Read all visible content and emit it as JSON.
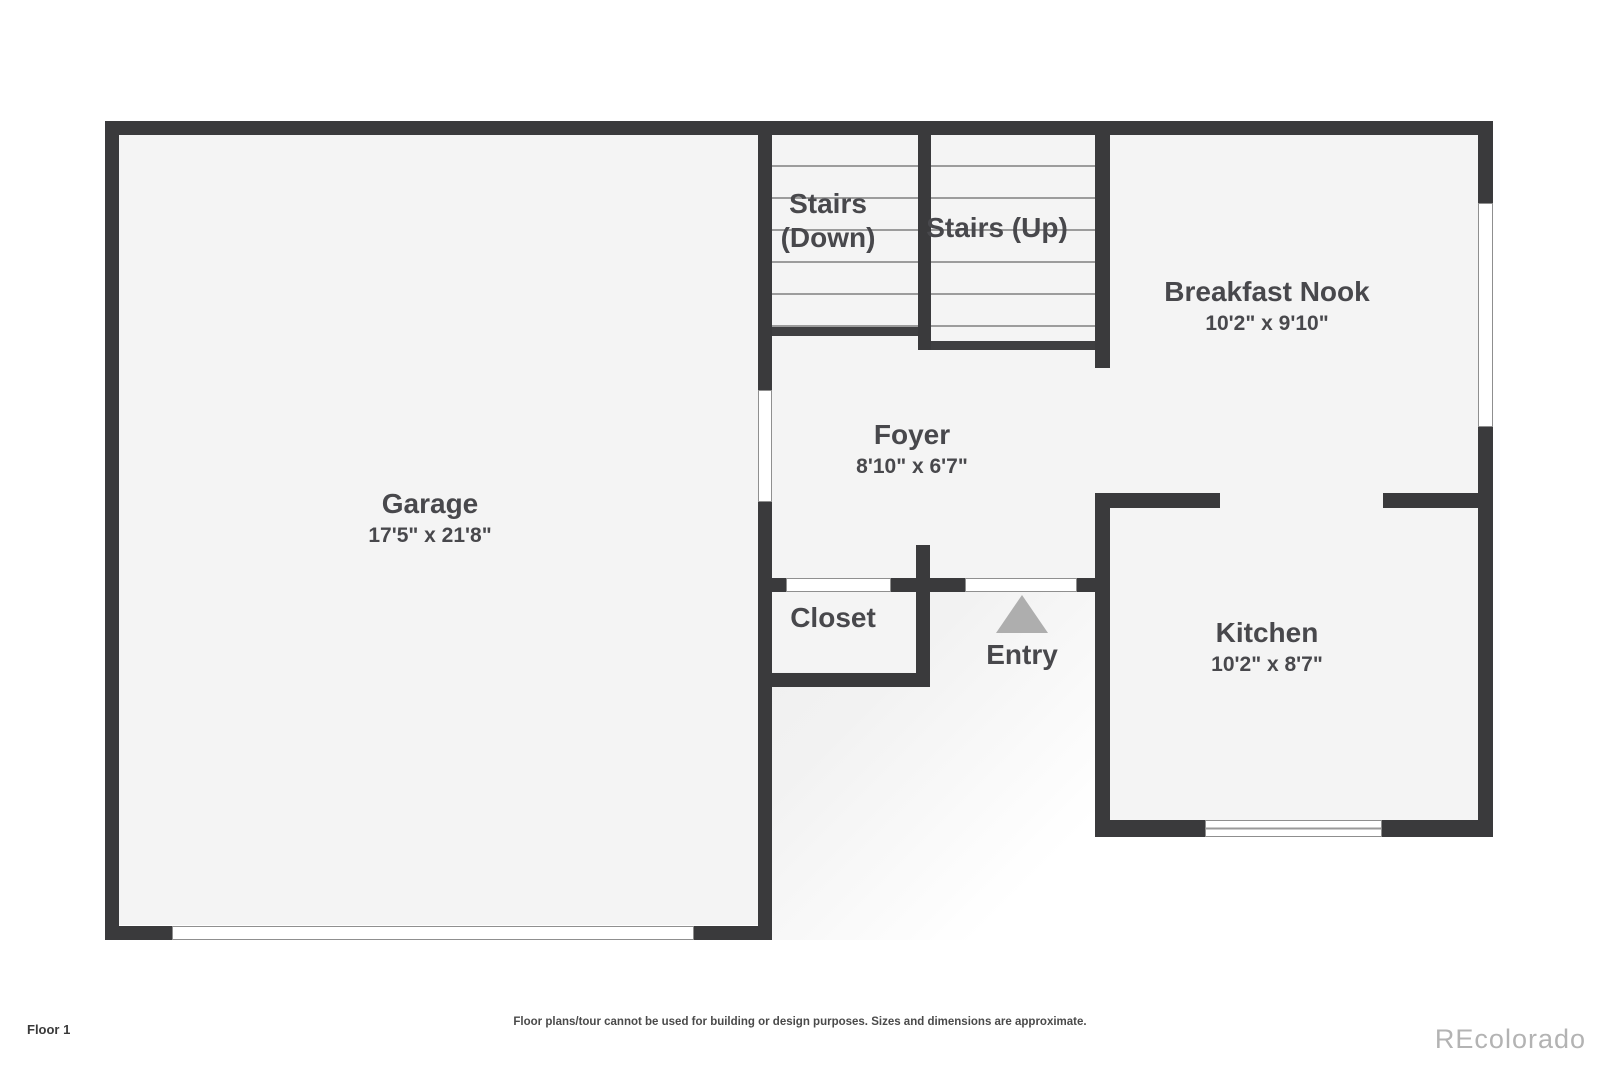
{
  "plan": {
    "floor_label": "Floor 1",
    "disclaimer": "Floor plans/tour cannot be used for building or design purposes. Sizes and dimensions are approximate.",
    "watermark": "REcolorado",
    "rooms": {
      "garage": {
        "name": "Garage",
        "dims": "17'5\" x 21'8\""
      },
      "stairs_down": {
        "line1": "Stairs",
        "line2": "(Down)"
      },
      "stairs_up": {
        "name": "Stairs (Up)"
      },
      "breakfast_nook": {
        "name": "Breakfast Nook",
        "dims": "10'2\" x 9'10\""
      },
      "foyer": {
        "name": "Foyer",
        "dims": "8'10\" x 6'7\""
      },
      "closet": {
        "name": "Closet"
      },
      "entry": {
        "name": "Entry"
      },
      "kitchen": {
        "name": "Kitchen",
        "dims": "10'2\" x 8'7\""
      }
    },
    "colors": {
      "wall": "#3a3a3c",
      "floor": "#f4f4f4",
      "label_text": "#48484c",
      "entry_arrow": "#aeaeae"
    }
  }
}
